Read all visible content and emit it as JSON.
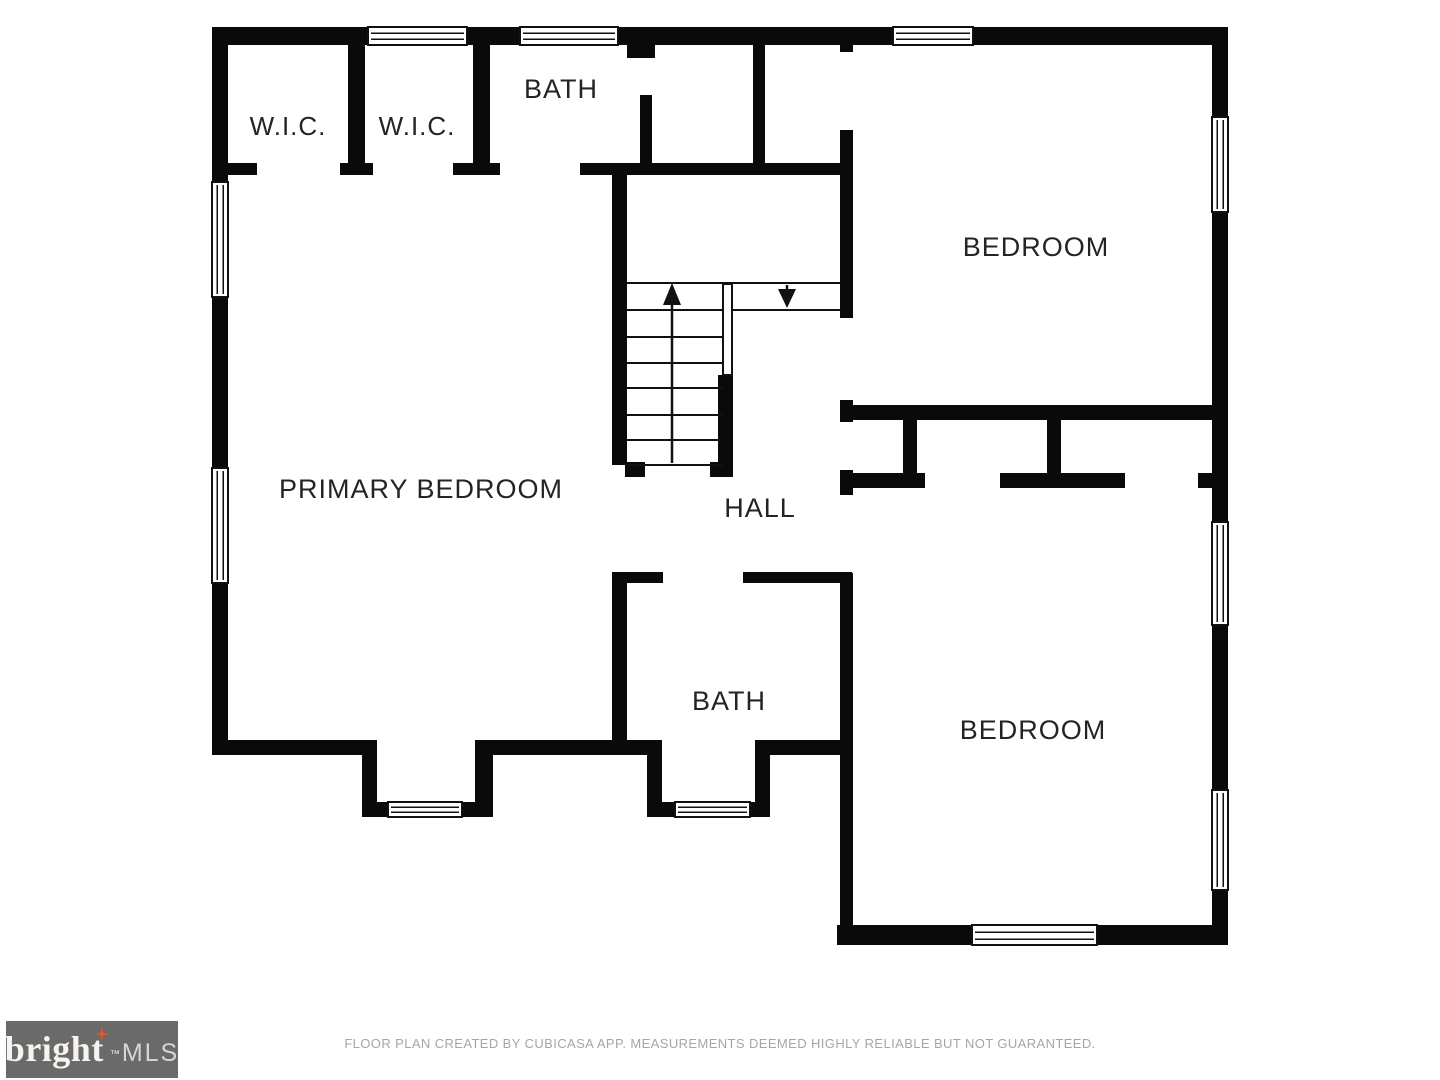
{
  "plan": {
    "rooms": {
      "wic_left": "W.I.C.",
      "wic_right": "W.I.C.",
      "bath_top": "BATH",
      "bedroom_top": "BEDROOM",
      "primary_bedroom": "PRIMARY BEDROOM",
      "hall": "HALL",
      "bath_bottom": "BATH",
      "bedroom_bottom": "BEDROOM"
    },
    "stairs": {
      "up_arrow": "up",
      "down_arrow": "down"
    }
  },
  "footer": {
    "disclaimer": "FLOOR PLAN CREATED BY CUBICASA APP. MEASUREMENTS DEEMED HIGHLY RELIABLE BUT NOT GUARANTEED."
  },
  "logo": {
    "brand": "bright",
    "suffix": "MLS",
    "trademark": "™"
  },
  "colors": {
    "wall": "#0a0a0a",
    "background": "#ffffff",
    "label_text": "#242424",
    "footer_text": "#a6a6a6",
    "logo_background": "#6a6a6a",
    "logo_brand_text": "#f7f4ef",
    "logo_suffix_text": "#d8d5d1",
    "logo_star": "#e0562a"
  }
}
